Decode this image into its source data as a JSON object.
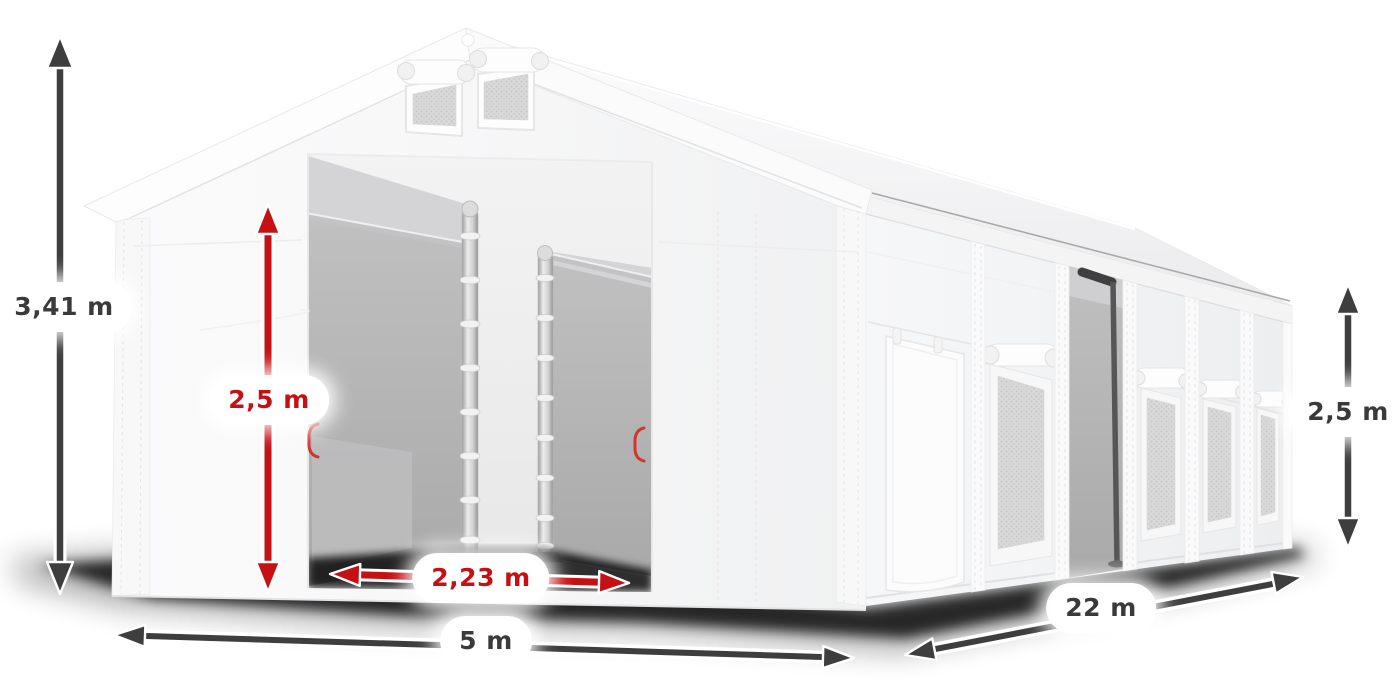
{
  "illustration": {
    "name": "tent-3d-render",
    "features": [
      "gable-roof",
      "two-roof-vents",
      "open-front-entrance",
      "inner-door-posts",
      "side-wall-windows",
      "side-door-panel",
      "open-side-doorway"
    ]
  },
  "dimensions": {
    "total_height": {
      "value": "3,41 m",
      "style": "dark"
    },
    "entrance_height": {
      "value": "2,5 m",
      "style": "red"
    },
    "entrance_width": {
      "value": "2,23 m",
      "style": "red"
    },
    "width": {
      "value": "5 m",
      "style": "dark"
    },
    "length": {
      "value": "22 m",
      "style": "dark"
    },
    "side_wall_height": {
      "value": "2,5 m",
      "style": "dark"
    }
  },
  "colors": {
    "page_background": "#ffffff",
    "arrow_dark": "#3e3e3e",
    "arrow_red": "#c51014",
    "label_dark_text": "#3a3a3a",
    "label_red_text": "#c51014",
    "label_background": "#ffffff",
    "tent_white": "#f7f7f8",
    "interior_gray": "#b2b2b2",
    "shadow_black": "#000000"
  }
}
